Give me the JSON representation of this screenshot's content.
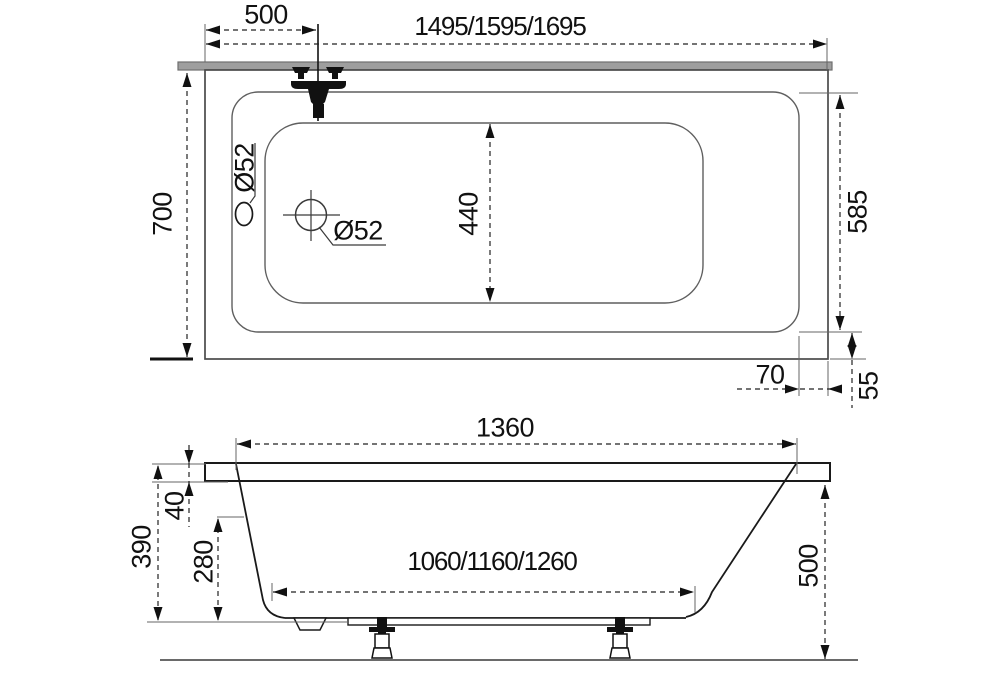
{
  "drawing": {
    "subject": "bathtub-technical-drawing",
    "views": {
      "top": "plan view",
      "side": "side elevation"
    }
  },
  "top_view": {
    "faucet_offset": "500",
    "total_length": "1495/1595/1695",
    "total_width": "700",
    "inner_width": "585",
    "basin_width": "440",
    "overflow_diameter": "Ø52",
    "drain_diameter": "Ø52",
    "rim_offset_side": "70",
    "rim_offset_end": "55"
  },
  "side_view": {
    "rim_length": "1360",
    "rim_thickness": "40",
    "shell_depth": "390",
    "basin_depth": "280",
    "base_length": "1060/1160/1260",
    "overall_height": "500"
  },
  "colors": {
    "outline": "#4a4a4a",
    "profile": "#1a1a1a",
    "dimension": "#222222",
    "wall_bar": "#9e9e9e",
    "background": "#ffffff"
  }
}
